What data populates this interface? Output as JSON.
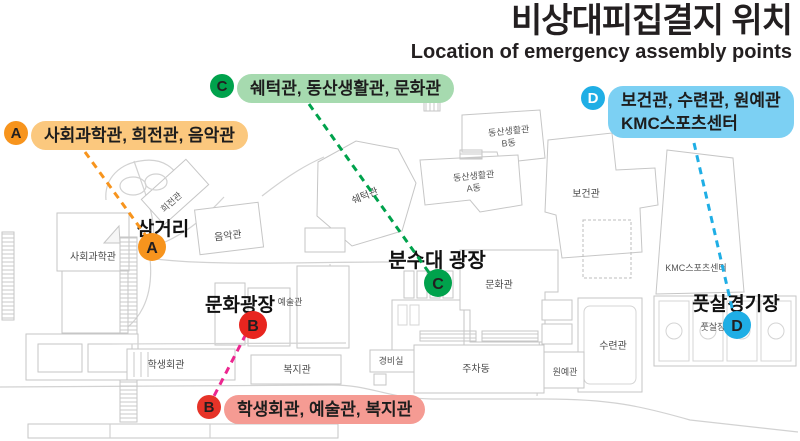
{
  "title": "비상대피집결지 위치",
  "subtitle": "Location of emergency assembly points",
  "legend": {
    "a": {
      "letter": "A",
      "label": "사회과학관, 희전관, 음악관"
    },
    "b": {
      "letter": "B",
      "label": "학생회관, 예술관, 복지관"
    },
    "c": {
      "letter": "C",
      "label": "쉐턱관, 동산생활관, 문화관"
    },
    "d": {
      "letter": "D",
      "label_line1": "보건관, 수련관, 원예관",
      "label_line2": "KMC스포츠센터"
    }
  },
  "colors": {
    "a_marker": "#F7941D",
    "a_bg": "#FBC87E",
    "b_marker": "#E63328",
    "b_bg": "#F59B93",
    "b_line": "#EC268F",
    "c_marker": "#00A24C",
    "c_bg": "#A6DAAF",
    "d_marker": "#1FAEE5",
    "d_bg": "#7CD0F3",
    "letter_dark": "#231F20",
    "letter_light": "#FFFFFF"
  },
  "map": {
    "places": {
      "samgeori": "삼거리",
      "bunsudae_plaza": "분수대 광장",
      "munhwa_plaza": "문화광장",
      "futsal_stadium": "풋살경기장"
    },
    "buildings": {
      "sahoegwahakgwan": "사회과학관",
      "huijeongwan": "희전관",
      "eumakgwan": "음악관",
      "swetakgwan": "쉐턱관",
      "dongsan_b_line1": "동산생활관",
      "dongsan_b_line2": "B동",
      "dongsan_a_line1": "동산생활관",
      "dongsan_a_line2": "A동",
      "bogeongwan": "보건관",
      "kmc": "KMC스포츠센터",
      "munhwagwan": "문화관",
      "yesulgwan": "예술관",
      "haksaenghoegwan": "학생회관",
      "bokjigwan": "복지관",
      "gyeongbisil": "경비실",
      "juchadong": "주차동",
      "suryeongwan": "수련관",
      "wonyegwan": "원예관",
      "futsaljang": "풋살장"
    }
  }
}
